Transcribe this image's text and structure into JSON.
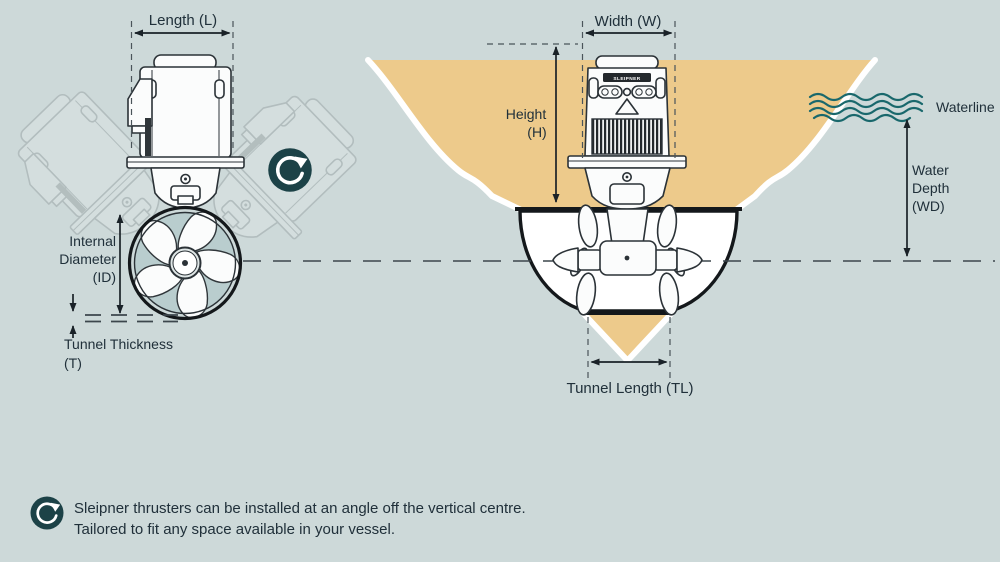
{
  "colors": {
    "background": "#cdd9d9",
    "hull_fill": "#edca8b",
    "waterline_teal": "#19686c",
    "icon_background": "#1c4247",
    "text": "#20303a",
    "line_art": "#2b3237",
    "propeller_gap": "#b9cdce"
  },
  "left_diagram": {
    "length_label": "Length (L)",
    "internal_diameter_label": [
      "Internal",
      "Diameter",
      "(ID)"
    ],
    "tunnel_thickness_label": [
      "Tunnel Thickness",
      "(T)"
    ]
  },
  "right_diagram": {
    "width_label": "Width (W)",
    "height_label": [
      "Height",
      "(H)"
    ],
    "waterline_label": "Waterline",
    "water_depth_label": [
      "Water",
      "Depth",
      "(WD)"
    ],
    "tunnel_length_label": "Tunnel Length (TL)",
    "motor_brand_label": "SLEIPNER"
  },
  "footer": {
    "note_lines": [
      "Sleipner thrusters can be installed at an angle off the vertical centre.",
      "Tailored to fit any space available in your vessel."
    ]
  }
}
